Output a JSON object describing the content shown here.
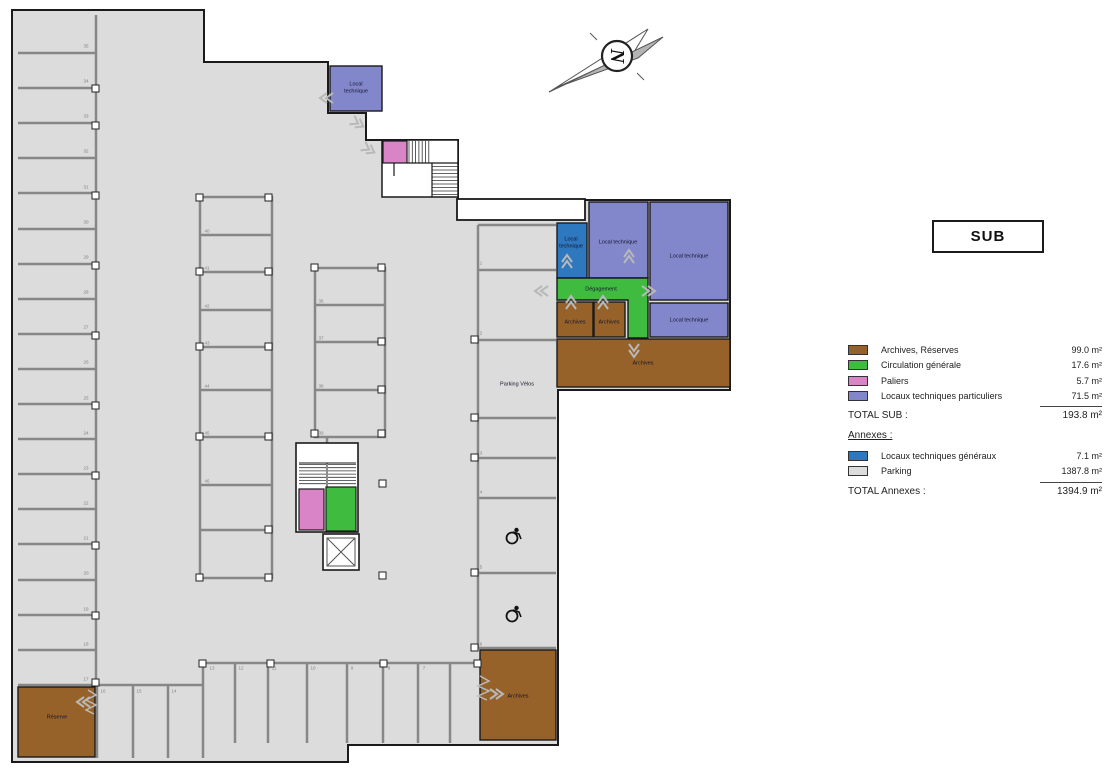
{
  "colors": {
    "brown": "#96622a",
    "green": "#3fbb3f",
    "pink": "#d884c6",
    "purple": "#8287cc",
    "blue": "#2e78c0",
    "parking": "#dcdcdc"
  },
  "north": {
    "letter": "N"
  },
  "title_box": {
    "label": "SUB"
  },
  "legend": {
    "items": [
      {
        "name": "Archives, Réserves",
        "value": "99.0 m²",
        "color": "#96622a"
      },
      {
        "name": "Circulation générale",
        "value": "17.6 m²",
        "color": "#3fbb3f"
      },
      {
        "name": "Paliers",
        "value": "5.7 m²",
        "color": "#d884c6"
      },
      {
        "name": "Locaux techniques particuliers",
        "value": "71.5 m²",
        "color": "#8287cc"
      }
    ],
    "total_sub_label": "TOTAL SUB :",
    "total_sub_value": "193.8 m²",
    "annexes_heading": "Annexes :",
    "annex_items": [
      {
        "name": "Locaux techniques généraux",
        "value": "7.1 m²",
        "color": "#2e78c0"
      },
      {
        "name": "Parking",
        "value": "1387.8 m²",
        "color": "#dcdcdc"
      }
    ],
    "total_annexes_label": "TOTAL Annexes :",
    "total_annexes_value": "1394.9 m²"
  },
  "plan": {
    "rooms": {
      "lt_top": "Local technique",
      "lt_blue": "Local technique",
      "lt_a": "Local technique",
      "lt_b": "Local technique",
      "lt_c": "Local technique",
      "degagement": "Dégagement",
      "archives_1": "Archives",
      "archives_2": "Archives",
      "archives_main": "Archives",
      "archives_br": "Archives",
      "reserve": "Réserve",
      "parking_velos": "Parking Vélos"
    },
    "parking_numbers": [
      {
        "n": "35",
        "x": 86,
        "y": 46
      },
      {
        "n": "34",
        "x": 86,
        "y": 81
      },
      {
        "n": "33",
        "x": 86,
        "y": 116
      },
      {
        "n": "32",
        "x": 86,
        "y": 151
      },
      {
        "n": "31",
        "x": 86,
        "y": 187
      },
      {
        "n": "30",
        "x": 86,
        "y": 222
      },
      {
        "n": "29",
        "x": 86,
        "y": 257
      },
      {
        "n": "28",
        "x": 86,
        "y": 292
      },
      {
        "n": "27",
        "x": 86,
        "y": 327
      },
      {
        "n": "26",
        "x": 86,
        "y": 362
      },
      {
        "n": "25",
        "x": 86,
        "y": 398
      },
      {
        "n": "24",
        "x": 86,
        "y": 433
      },
      {
        "n": "23",
        "x": 86,
        "y": 468
      },
      {
        "n": "22",
        "x": 86,
        "y": 503
      },
      {
        "n": "21",
        "x": 86,
        "y": 538
      },
      {
        "n": "20",
        "x": 86,
        "y": 573
      },
      {
        "n": "19",
        "x": 86,
        "y": 609
      },
      {
        "n": "18",
        "x": 86,
        "y": 644
      },
      {
        "n": "17",
        "x": 86,
        "y": 679
      },
      {
        "n": "40",
        "x": 207,
        "y": 231
      },
      {
        "n": "41",
        "x": 207,
        "y": 268
      },
      {
        "n": "42",
        "x": 207,
        "y": 306
      },
      {
        "n": "43",
        "x": 207,
        "y": 343
      },
      {
        "n": "44",
        "x": 207,
        "y": 386
      },
      {
        "n": "45",
        "x": 207,
        "y": 433
      },
      {
        "n": "46",
        "x": 207,
        "y": 481
      },
      {
        "n": "36",
        "x": 321,
        "y": 301
      },
      {
        "n": "37",
        "x": 321,
        "y": 338
      },
      {
        "n": "38",
        "x": 321,
        "y": 386
      },
      {
        "n": "39",
        "x": 321,
        "y": 433
      },
      {
        "n": "1",
        "x": 481,
        "y": 263
      },
      {
        "n": "2",
        "x": 481,
        "y": 333
      },
      {
        "n": "3",
        "x": 481,
        "y": 453
      },
      {
        "n": "4",
        "x": 481,
        "y": 492
      },
      {
        "n": "5",
        "x": 481,
        "y": 567
      },
      {
        "n": "6",
        "x": 481,
        "y": 644
      },
      {
        "n": "16",
        "x": 103,
        "y": 691
      },
      {
        "n": "15",
        "x": 139,
        "y": 691
      },
      {
        "n": "14",
        "x": 174,
        "y": 691
      },
      {
        "n": "13",
        "x": 212,
        "y": 668
      },
      {
        "n": "12",
        "x": 241,
        "y": 668
      },
      {
        "n": "11",
        "x": 274,
        "y": 668
      },
      {
        "n": "10",
        "x": 313,
        "y": 668
      },
      {
        "n": "9",
        "x": 352,
        "y": 668
      },
      {
        "n": "8",
        "x": 389,
        "y": 668
      },
      {
        "n": "7",
        "x": 424,
        "y": 668
      }
    ]
  }
}
